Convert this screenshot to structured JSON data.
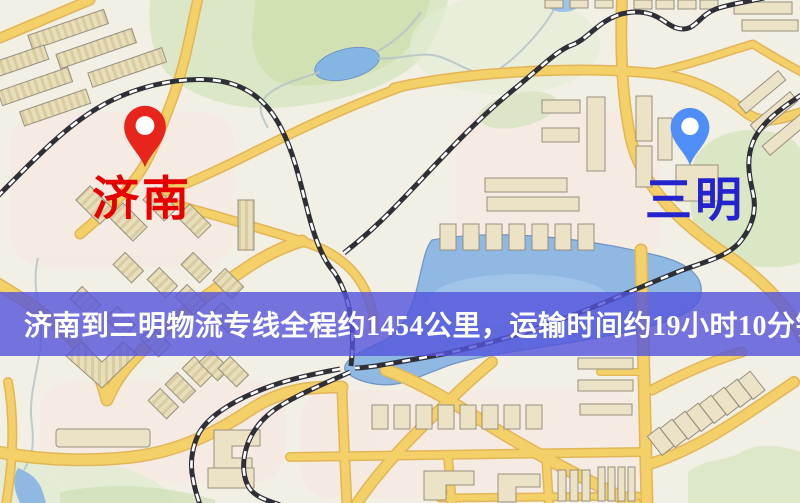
{
  "map": {
    "markers": [
      {
        "id": "origin",
        "label": "济南",
        "label_color": "#e60000",
        "pin_color": "#e8251c"
      },
      {
        "id": "destination",
        "label": "三明",
        "label_color": "#2424cf",
        "pin_color": "#4f8ef6"
      }
    ],
    "banner": {
      "text": "济南到三明物流专线全程约1454公里，运输时间约19小时10分钟.",
      "background": "#5454dc",
      "text_color": "#ffffff"
    },
    "legend_colors": {
      "road": "#f4d069",
      "railway": "#2f2f38",
      "water": "#8fb9e2",
      "park": "#d9e6c2",
      "building": "#ece2c6"
    }
  }
}
